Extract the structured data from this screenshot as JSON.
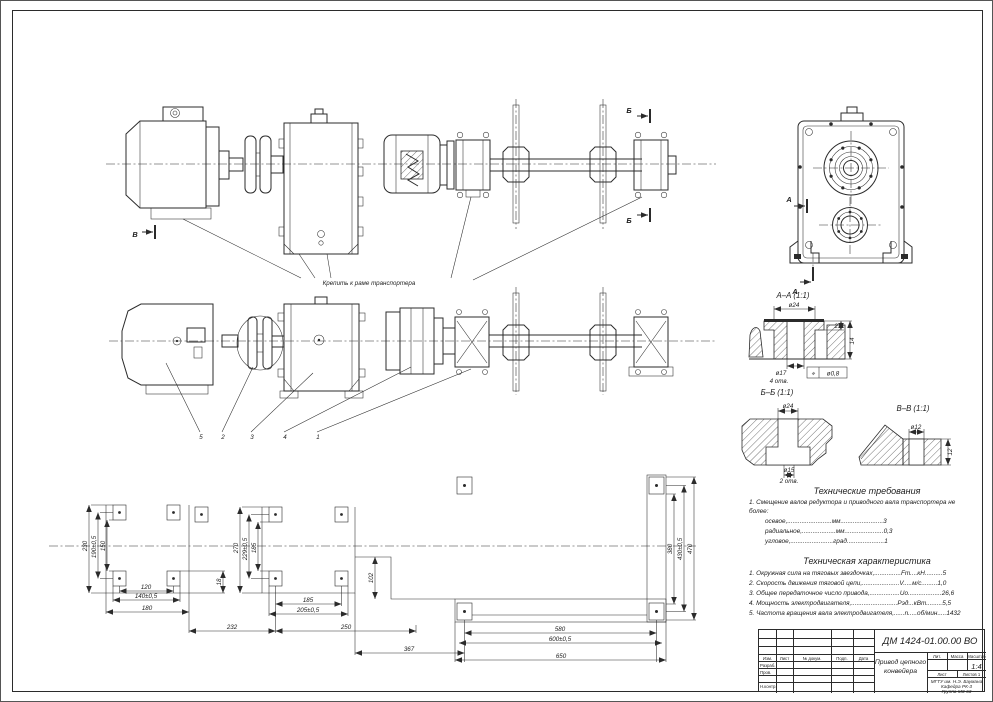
{
  "sheet": {
    "paper": "#ffffff",
    "line_color": "#2b2b2b"
  },
  "views": {
    "attach_note": "Крепить к раме транспортера",
    "positions": [
      "5",
      "2",
      "3",
      "4",
      "1"
    ],
    "letters": {
      "a": "А",
      "b": "Б",
      "v": "В"
    }
  },
  "sections": {
    "aa": {
      "title": "А–А (1:1)",
      "dia_top": "ø24",
      "dia_hole": "ø17",
      "holes_note": "4 отв.",
      "dim_small": "2",
      "dim_height": "14",
      "gdt_symbol": "⌖",
      "gdt_value": "ø0,8"
    },
    "bb": {
      "title": "Б–Б (1:1)",
      "dia_top": "ø24",
      "dia_hole": "ø15",
      "holes_note": "2 отв."
    },
    "vv": {
      "title": "В–В (1:1)",
      "dia_top": "ø12",
      "dim_height": "12"
    }
  },
  "layout_dims": {
    "motor_v": [
      "230",
      "190±0,5",
      "150"
    ],
    "motor_h": [
      "120",
      "140±0,5",
      "180"
    ],
    "gap_left": "18",
    "gear_v": [
      "270",
      "229±0,5",
      "185"
    ],
    "gear_h": [
      "185",
      "205±0,5"
    ],
    "chain": [
      "232",
      "250",
      "367"
    ],
    "gap_right": "102",
    "bear_v": [
      "380",
      "430±0,5",
      "470"
    ],
    "bear_h": [
      "580",
      "600±0,5",
      "650"
    ]
  },
  "tech_requirements": {
    "title": "Технические требования",
    "intro1": "1. Смещение валов редуктора и приводного вала транспортера не",
    "intro2": "более:",
    "items": [
      "осевое,.........................мм........................3",
      "радиальное,...................мм......................0,3",
      "угловое,........................град.....................1"
    ]
  },
  "tech_characteristics": {
    "title": "Техническая характеристика",
    "items": [
      "1. Окружная сила на тяговых звездочках,...............Fт....кН..........5",
      "2. Скорость движения тяговой цепи,.....................V.....м/с.........1,0",
      "3. Общее передаточное число привода,.................Uо...................26,6",
      "4. Мощность электродвигателя,..........................Рэд...кВт.........5,5",
      "5. Частота вращения вала электродвигателя,......n.....об/мин.....1432"
    ]
  },
  "title_block": {
    "doc_number": "ДМ 1424-01.00.00 ВО",
    "name_line1": "Привод цепного",
    "name_line2": "конвейера",
    "col_izm": "Изм.",
    "col_list": "Лист",
    "col_doc": "№ докум.",
    "col_sign": "Подп.",
    "col_date": "Дата",
    "row_dev": "Разраб.",
    "row_check": "Пров.",
    "row_ncontr": "Н.контр.",
    "lit_label": "Лит.",
    "mass_label": "Масса",
    "scale_label": "Масштаб",
    "scale_value": "1:4",
    "sheet_label": "Лист",
    "sheets_label": "Листов 1",
    "org_line1": "МГТУ им. Н.Э. Баумана",
    "org_line2": "Кафедра РК-3",
    "org_line3": "Группа МЗ-63"
  }
}
